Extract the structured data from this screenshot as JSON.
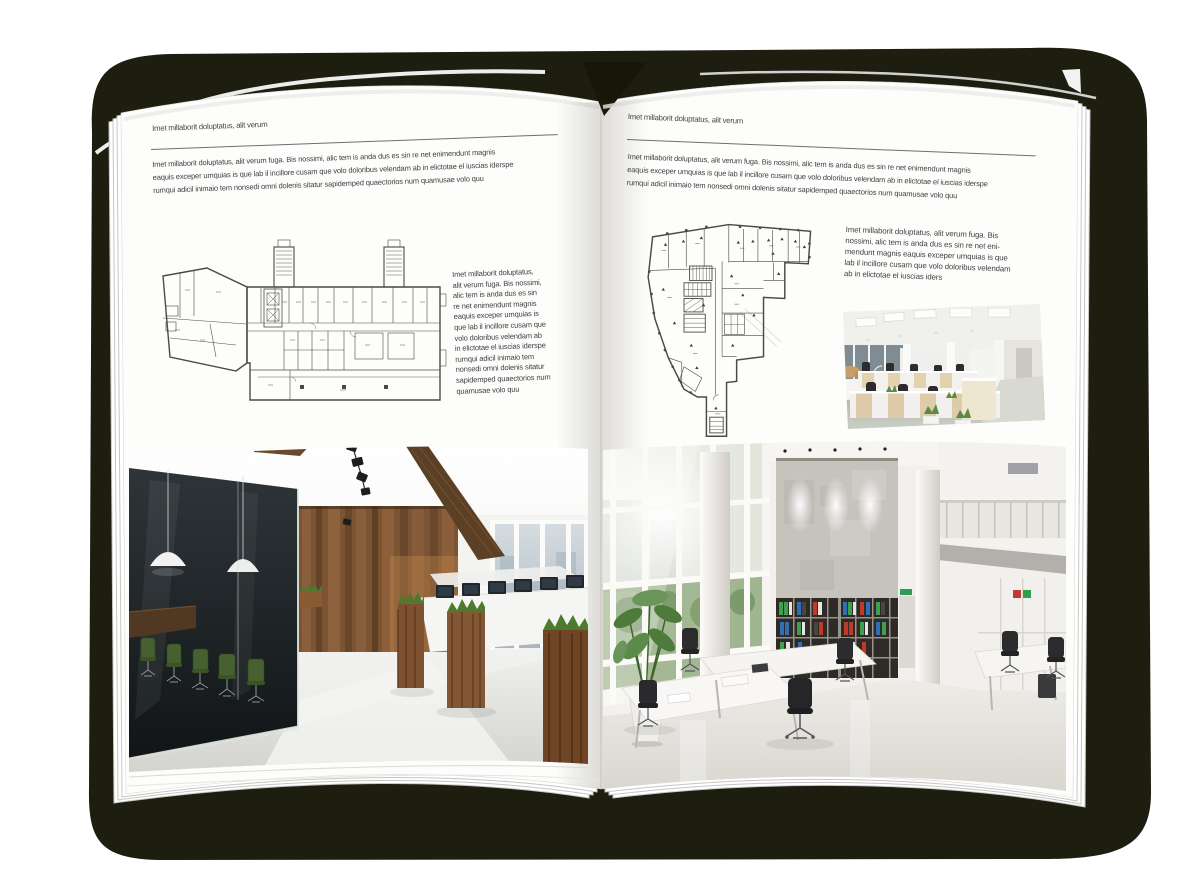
{
  "mockup": {
    "description": "open brochure spread mockup on white background"
  },
  "colors": {
    "cover": "#1d1d10",
    "page": "#fdfdfc",
    "text": "#3f3f3f",
    "rule": "#6e6e6e",
    "plan_line": "#4a4a47",
    "wood": "#7b5433",
    "meeting_glass": "#1a2023",
    "chair_green": "#47602f",
    "grass": "#4d7a2e",
    "binder_green": "#3f9e4f",
    "binder_blue": "#2f6fb5",
    "binder_red": "#bf3a2b"
  },
  "left_page": {
    "header": "Imet millaborit doluptatus, alit verum",
    "intro_lines": [
      "Imet millaborit doluptatus, alit verum fuga. Bis nossimi, alic tem is anda dus es sin re net enimendunt magnis",
      "eaquis exceper umquias is que lab il incillore cusam que volo doloribus velendam ab in elictotae el iuscias iderspe",
      "rumqui adicil inimaio tem nonsedi omni dolenis sitatur sapidemped quaectorios num quamusae volo quu"
    ],
    "side_lines": [
      "Imet millaborit doluptatus,",
      "alit verum fuga. Bis nossimi,",
      "alic tem is anda dus es sin",
      "re net enimendunt magnis",
      "eaquis exceper umquias is",
      "que lab il incillore cusam que",
      "volo doloribus velendam ab",
      "in elictotae el iuscias iderspe",
      "rumqui adicil inimaio tem",
      "nonsedi omni dolenis sitatur",
      "sapidemped quaectorios num",
      "quamusae volo quu"
    ],
    "floorplan_description": "floor plan of elongated office wing with two stair towers and angled annex",
    "photo_description": "office interior with glass meeting room, green chairs, wooden feature wall and grass planter boxes"
  },
  "right_page": {
    "header": "Imet millaborit doluptatus, alit verum",
    "intro_lines": [
      "Imet millaborit doluptatus, alit verum fuga. Bis nossimi, alic tem is anda dus es sin re net enimendunt magnis",
      "eaquis exceper umquias is que lab il incillore cusam que volo doloribus velendam ab in elictotae el iuscias iderspe",
      "rumqui adicil inimaio tem nonsedi omni dolenis sitatur sapidemped quaectorios num quamusae volo quu"
    ],
    "side_lines": [
      "Imet millaborit doluptatus, alit verum fuga. Bis",
      "nossimi, alic tem is anda dus es sin re net eni-",
      "mendunt magnis eaquis exceper umquias is que",
      "lab il incillore cusam que volo doloribus velendam",
      "ab in elictotae el iuscias iders"
    ],
    "floorplan_description": "floor plan of irregular corner building with central core and lower stair tail",
    "photo_small_description": "open-plan office with light wood workstations and glass partitions",
    "photo_large_description": "double-height white office atrium with glazed wall, concrete feature wall, binder shelves and mezzanine"
  }
}
